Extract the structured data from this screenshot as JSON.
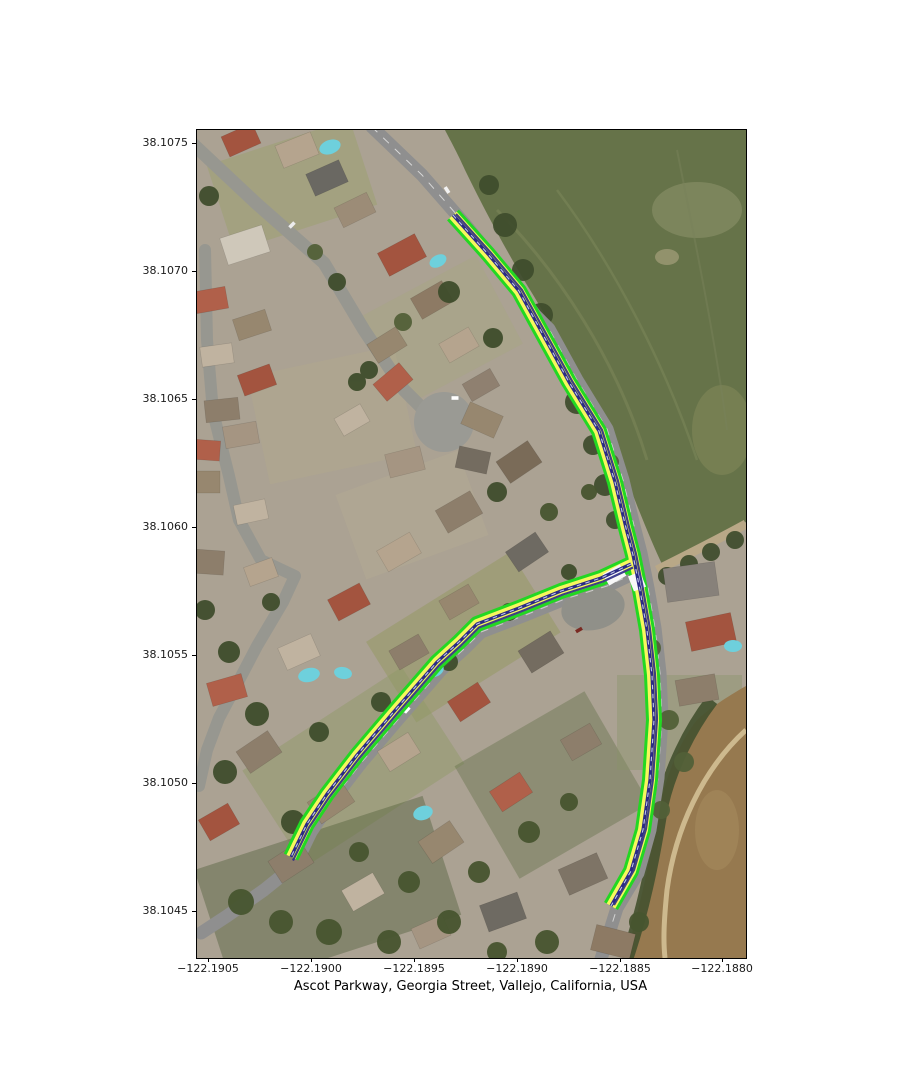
{
  "figure": {
    "xlabel": "Ascot Parkway, Georgia Street, Vallejo, California, USA",
    "x_ticks": [
      "−122.1905",
      "−122.1900",
      "−122.1895",
      "−122.1890",
      "−122.1885",
      "−122.1880"
    ],
    "y_ticks": [
      "38.1075",
      "38.1070",
      "38.1065",
      "38.1060",
      "38.1055",
      "38.1050",
      "38.1045"
    ]
  },
  "map": {
    "description": "Aerial satellite view of a residential neighborhood with two highlighted routes",
    "routes": [
      {
        "name": "Ascot Parkway",
        "path": "M256,85 L291,124 L322,161 L344,201 L372,252 L402,301 L418,352 L429,398 L436,425 L443,460 L450,500 L455,545 L457,590 L453,650 L446,700 L434,741 L414,776"
      },
      {
        "name": "Georgia Street",
        "path": "M434,434 L404,448 L364,461 L322,478 L280,494 L262,512 L240,532 L200,578 L160,625 L130,664 L110,694 L94,727"
      }
    ],
    "route_style": {
      "outline": "#22d822",
      "fill": "#f7f75e",
      "centerline": "#2b2b85",
      "dash": "#d9e1f8",
      "marker": "#f8f8f8"
    },
    "junction_markers": [
      {
        "path": "M426,440 L409,450"
      },
      {
        "path": "M437,444 L443,459"
      }
    ]
  }
}
